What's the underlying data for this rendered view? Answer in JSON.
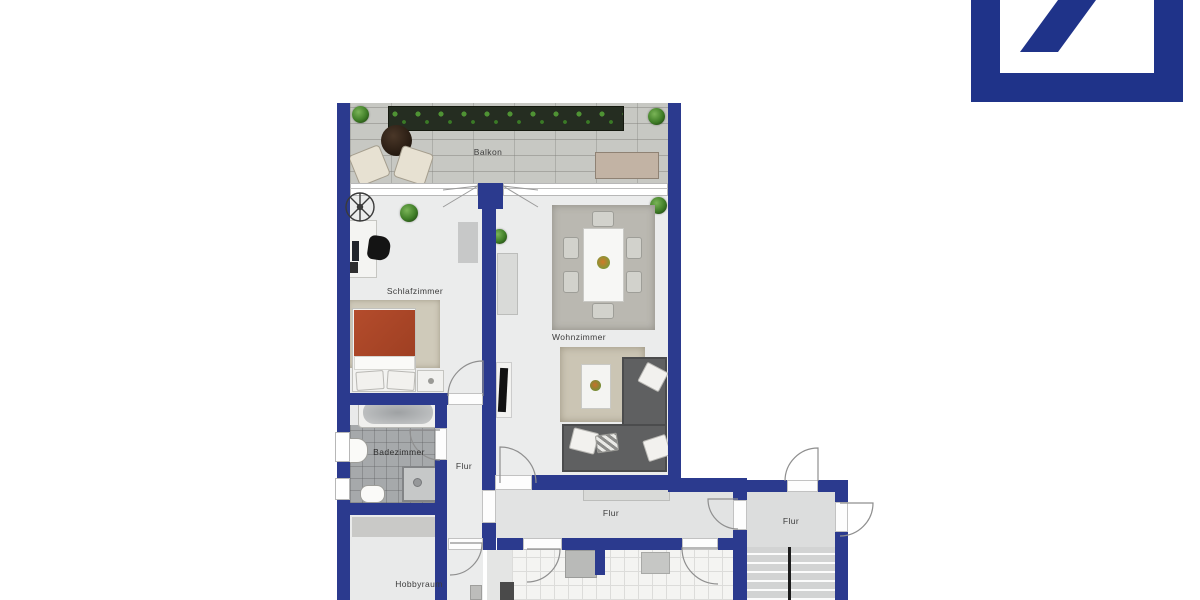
{
  "brand": {
    "logo_name": "deutsche-bank-slash-logo",
    "logo_color": "#1f3389"
  },
  "floor_plan": {
    "wall_color": "#2b3a8e",
    "labels": {
      "balcony": "Balkon",
      "bedroom": "Schlafzimmer",
      "living_room": "Wohnzimmer",
      "bathroom": "Badezimmer",
      "hallway_middle": "Flur",
      "hallway_south": "Flur",
      "hallway_stairwell": "Flur",
      "hobby_room": "Hobbyraum"
    }
  }
}
